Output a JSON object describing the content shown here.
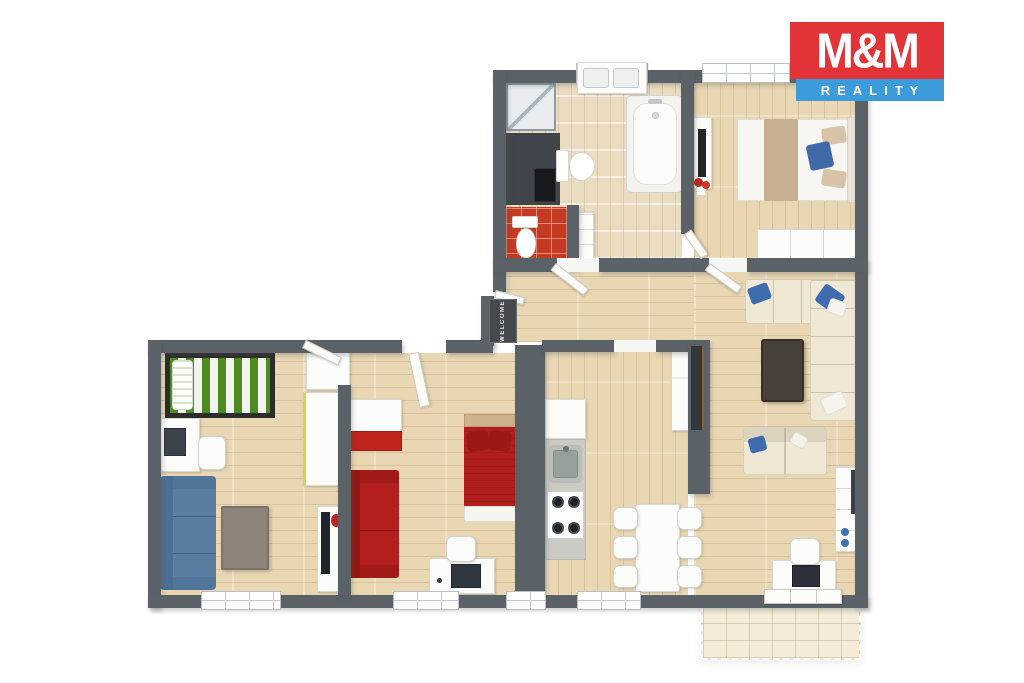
{
  "brand": {
    "line1": "M&M",
    "line2": "REALITY",
    "red": "#e23438",
    "blue": "#3b9bdb",
    "text_color": "#ffffff"
  },
  "entry": {
    "doormat_text": "WELCOME"
  },
  "palette": {
    "wall": "#5a6167",
    "wood_floor": "#e9d7b3",
    "bath_tile": "#eadcc0",
    "wc_tile": "#c53a22",
    "terrace_tile": "#f4ecd9",
    "sofa_cream": "#efe8d5",
    "sofa_blue": "#5a7da2",
    "sofa_red": "#b21f1c",
    "bed_green_stripe": "#4e8c21",
    "pillow_blue": "#3e6cae",
    "coffee_table_dark": "#474039"
  },
  "rooms": [
    {
      "name": "bathroom",
      "furniture": [
        "shower",
        "utility-niche",
        "washing-machine",
        "toilet",
        "bathtub",
        "double-sink-vanity",
        "drawer-cabinet"
      ]
    },
    {
      "name": "wc",
      "furniture": [
        "toilet"
      ]
    },
    {
      "name": "bedroom-main",
      "furniture": [
        "double-bed",
        "tv-stand",
        "tv",
        "flower-decor",
        "wardrobe"
      ]
    },
    {
      "name": "living-room",
      "furniture": [
        "corner-sofa",
        "coffee-table",
        "loveseat",
        "shelf-unit",
        "desk",
        "monitor",
        "office-chair"
      ]
    },
    {
      "name": "kitchen-dining",
      "furniture": [
        "upper-cabinet",
        "countertop",
        "sink",
        "gas-stove",
        "fridge",
        "dining-table",
        "six-chairs"
      ]
    },
    {
      "name": "kids-room",
      "furniture": [
        "single-bed-green",
        "desk",
        "computer",
        "chair",
        "blue-sofa",
        "coffee-table",
        "tv-stand"
      ]
    },
    {
      "name": "bedroom-2",
      "furniture": [
        "wardrobe",
        "red-sofa",
        "single-bed-red",
        "desk",
        "computer",
        "chair"
      ]
    },
    {
      "name": "hallway",
      "furniture": [
        "doormat"
      ]
    },
    {
      "name": "terrace",
      "furniture": []
    }
  ]
}
